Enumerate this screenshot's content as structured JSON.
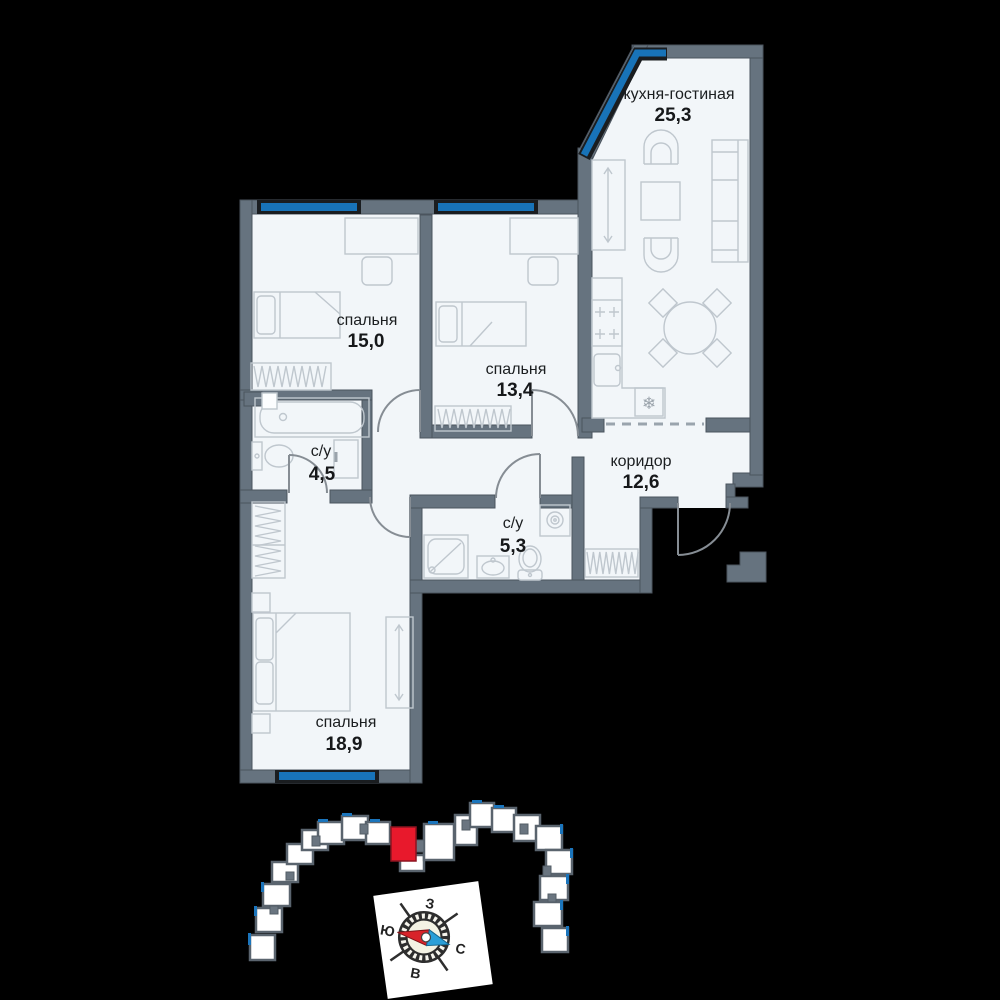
{
  "plan": {
    "rooms": [
      {
        "key": "kitchen-living",
        "name": "кухня-гостиная",
        "area": "25,3"
      },
      {
        "key": "bedroom-1",
        "name": "спальня",
        "area": "15,0"
      },
      {
        "key": "bedroom-2",
        "name": "спальня",
        "area": "13,4"
      },
      {
        "key": "bathroom-1",
        "name": "с/у",
        "area": "4,5"
      },
      {
        "key": "bathroom-2",
        "name": "с/у",
        "area": "5,3"
      },
      {
        "key": "corridor",
        "name": "коридор",
        "area": "12,6"
      },
      {
        "key": "bedroom-3",
        "name": "спальня",
        "area": "18,9"
      }
    ]
  },
  "compass": {
    "west": "З",
    "south": "Ю",
    "north": "С",
    "east": "В"
  },
  "colors": {
    "wall": "#66737f",
    "window": "#1873b8",
    "floor": "#f2f6f9",
    "furniture": "#bfc7ce",
    "highlight": "#e8192c",
    "needle_red": "#d8232a",
    "needle_blue": "#2b9fd8",
    "background": "#000000"
  }
}
